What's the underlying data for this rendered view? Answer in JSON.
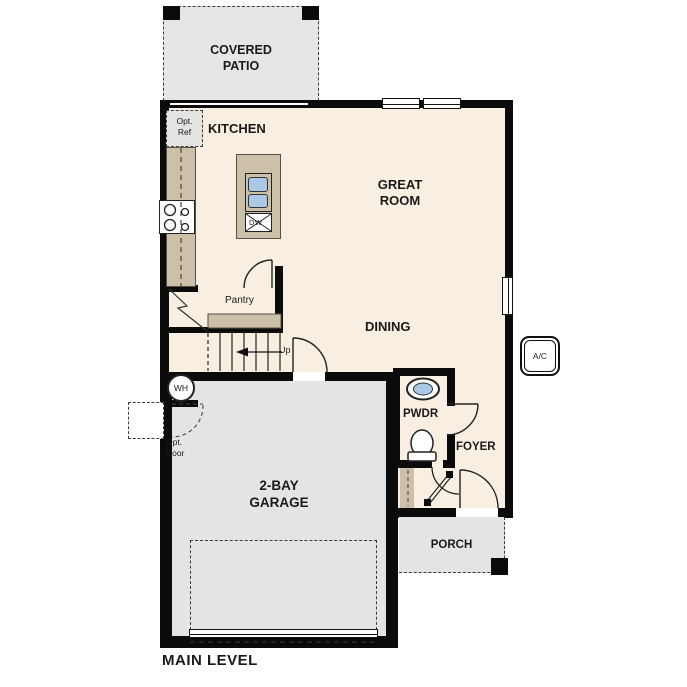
{
  "plan_title": "MAIN LEVEL",
  "rooms": {
    "covered_patio": "COVERED\nPATIO",
    "kitchen": "KITCHEN",
    "great_room": "GREAT\nROOM",
    "dining": "DINING",
    "pantry": "Pantry",
    "garage": "2-BAY\nGARAGE",
    "pwdr": "PWDR",
    "foyer": "FOYER",
    "porch": "PORCH"
  },
  "labels": {
    "opt_ref": "Opt.\nRef",
    "opt_door": "Opt.\nDoor",
    "stairs_up": "Up",
    "water_heater": "WH",
    "ac_unit": "A/C",
    "dishwasher": "DW"
  },
  "colors": {
    "interior": "#f8efe2",
    "garage_porch_patio": "#e5e4e2",
    "counter_tan": "#cdc0a8",
    "sink_blue": "#aac7e5",
    "wall_black": "#0b0b0b"
  }
}
